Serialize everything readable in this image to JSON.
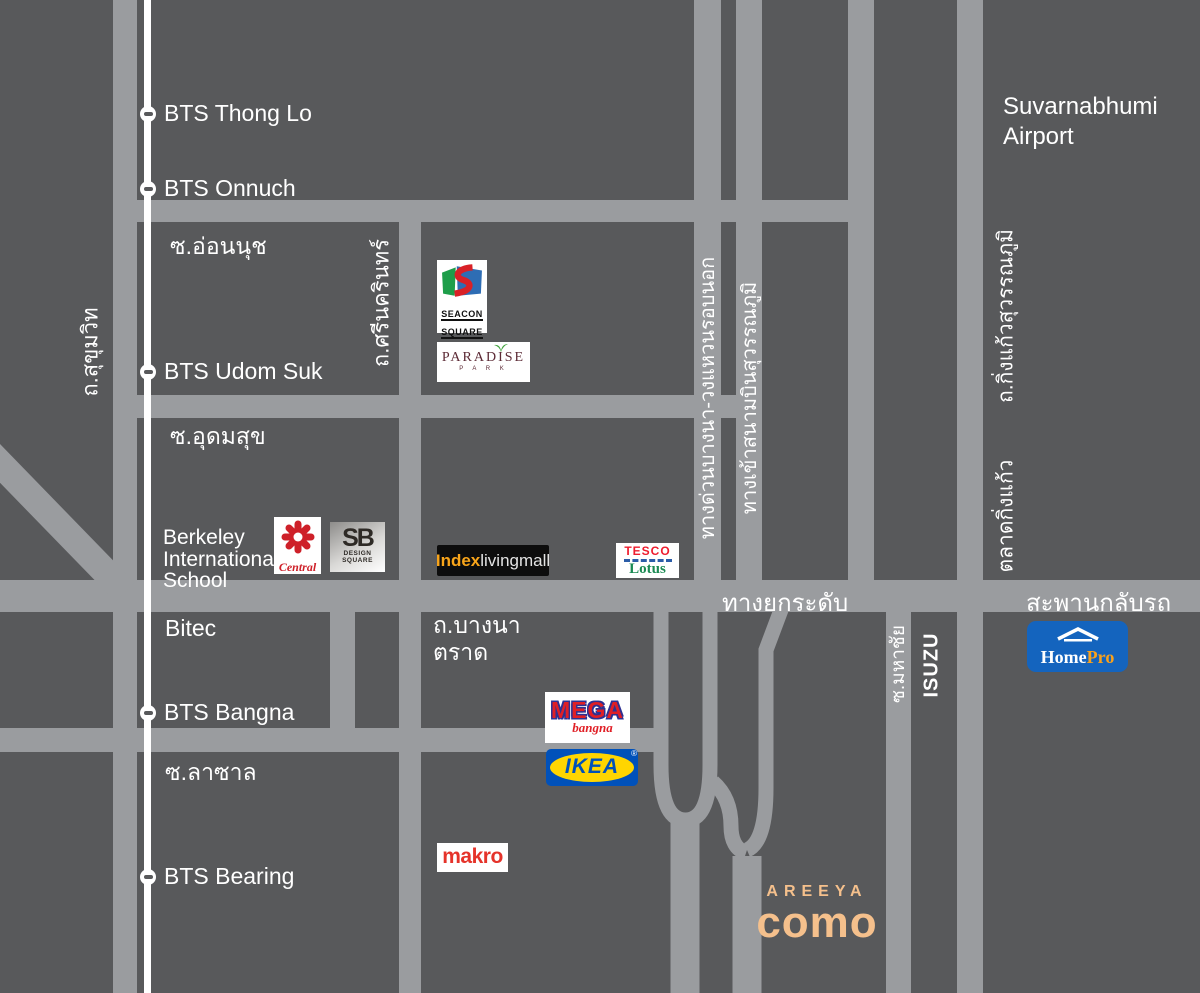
{
  "colors": {
    "background": "#58595B",
    "road": "#9A9C9F",
    "bts_line": "#FFFFFF",
    "areeya_peach": "#F5C08C",
    "homepro_blue": "#1464BE",
    "homepro_orange": "#F9A11B",
    "ikea_blue": "#0051BA",
    "ikea_yellow": "#FFD500",
    "mega_red": "#E01F26",
    "mega_outline_blue": "#2E3192",
    "makro_red": "#E5332A",
    "tesco_red": "#EE1C2E",
    "tesco_blue": "#2B5DA8",
    "lotus_green": "#1B8A53",
    "central_red": "#CE2029",
    "index_yellow": "#F9A51A",
    "seacon_red": "#D92127",
    "seacon_green": "#1E9E4A",
    "seacon_blue": "#2E6DB4",
    "paradise_maroon": "#5C2A35"
  },
  "stations": [
    {
      "label": "BTS Thong Lo"
    },
    {
      "label": "BTS Onnuch"
    },
    {
      "label": "BTS Udom Suk"
    },
    {
      "label": "BTS Bangna"
    },
    {
      "label": "BTS Bearing"
    }
  ],
  "areas": {
    "soi_onnuch": "ซ.อ่อนนุช",
    "soi_udomsuk": "ซ.อุดมสุข",
    "soi_lasalle": "ซ.ลาซาล",
    "bitec": "Bitec",
    "berkeley_line1": "Berkeley",
    "berkeley_line2": "International",
    "berkeley_line3": "School",
    "suvarnabhumi_line1": "Suvarnabhumi",
    "suvarnabhumi_line2": "Airport"
  },
  "road_labels": {
    "sukhumvit": "ถ.สุขุมวิท",
    "srinakarin": "ถ.ศรีนครินทร์",
    "bangna_ringroad_expwy": "ทางด่วนบางนา-วงแหวนรอบนอก",
    "airport_access": "ทางเข้าสนามบินสุวรรณภูมิ",
    "elevated_road": "ทางยกระดับ",
    "uturn_bridge": "สะพานกลับรถ",
    "bangna_trat_line1": "ถ.บางนา",
    "bangna_trat_line2": "ตราด",
    "soi_mahachai": "ซ.มหาชัย",
    "isuzu": "ISUZU",
    "king_kaeo_road": "ถ.กิ่งแก้วสุวรรณภูมิ",
    "king_kaeo_market": "ตลาดกิ่งแก้ว"
  },
  "logos": {
    "seacon": {
      "line1": "SEACON",
      "line2": "SQUARE"
    },
    "paradise": {
      "name": "PARADISE",
      "sub": "P A R K"
    },
    "central": {
      "name": "Central"
    },
    "sb": {
      "name": "SB",
      "sub1": "DESIGN",
      "sub2": "SQUARE"
    },
    "index": {
      "bold": "Index",
      "rest": "livingmall"
    },
    "tesco": {
      "top": "TESCO",
      "bottom": "Lotus"
    },
    "mega": {
      "name": "MEGA",
      "sub": "bangna"
    },
    "ikea": {
      "name": "IKEA",
      "reg": "®"
    },
    "makro": {
      "name": "makro"
    },
    "homepro": {
      "part1": "Home",
      "part2": "Pro"
    },
    "areeya": {
      "brand": "AREEYA",
      "project": "como"
    }
  }
}
